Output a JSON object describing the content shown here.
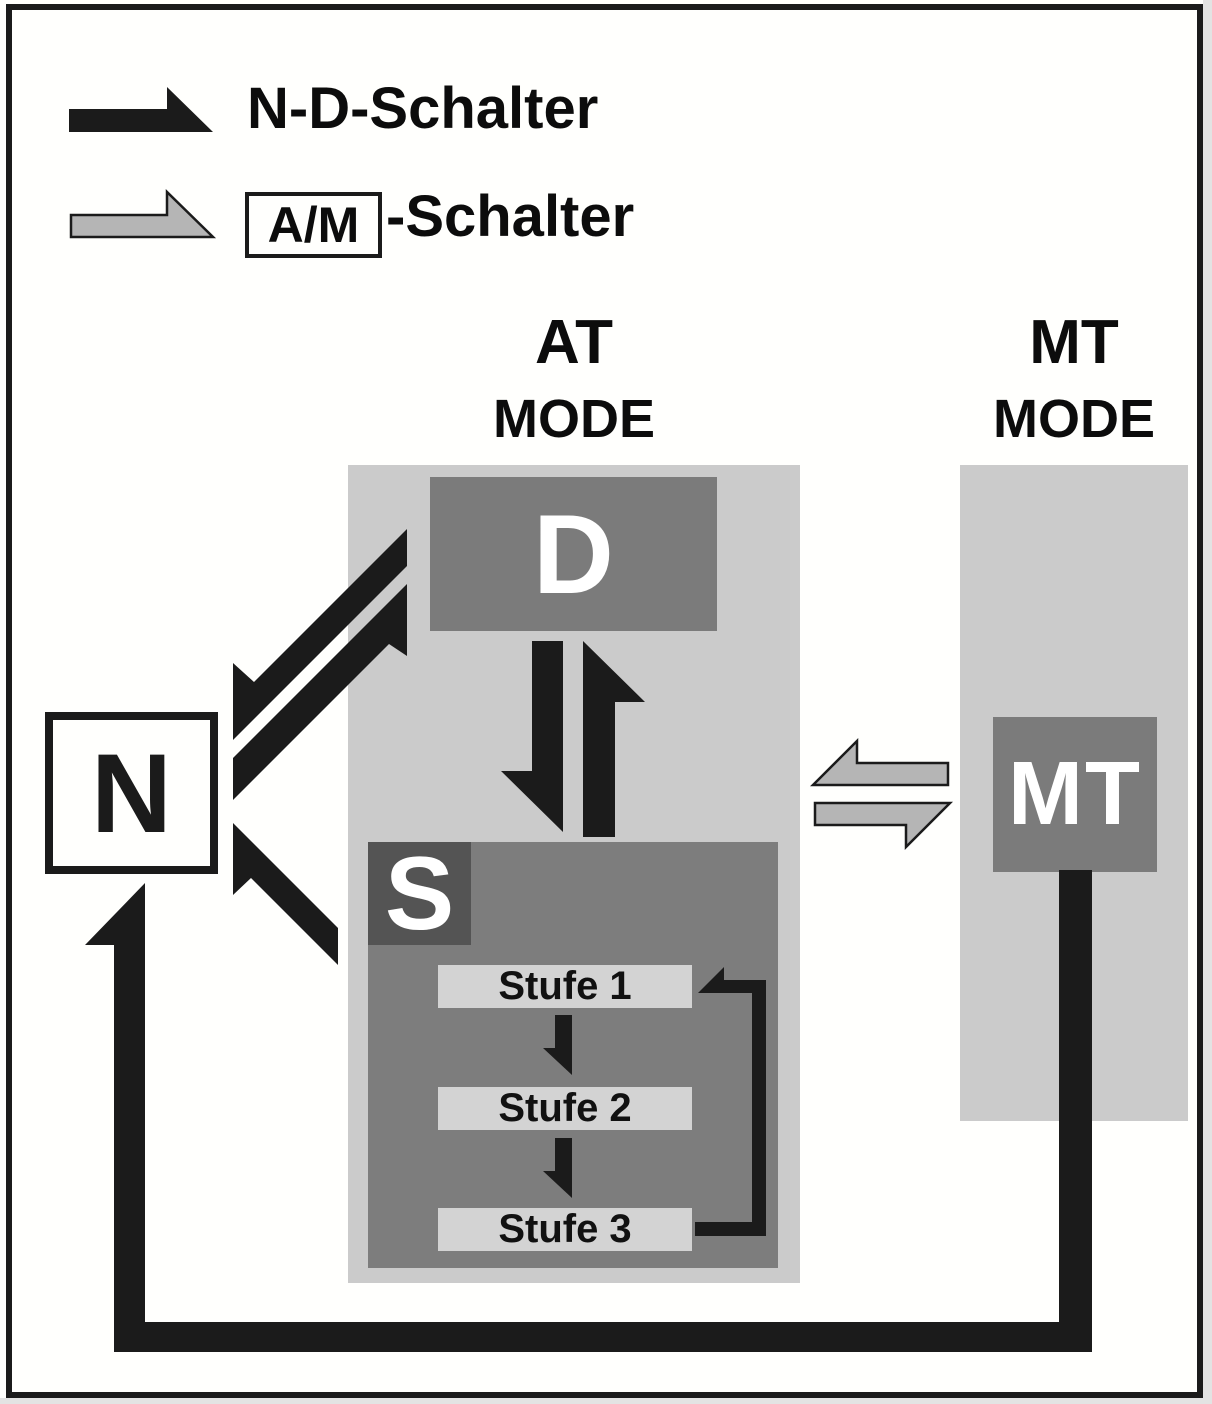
{
  "legend": {
    "nd_label": "N-D-Schalter",
    "am_box_label": "A/M",
    "am_suffix": "-Schalter"
  },
  "headers": {
    "at_title": "AT",
    "at_subtitle": "MODE",
    "mt_title": "MT",
    "mt_subtitle": "MODE"
  },
  "nodes": {
    "drive": "D",
    "neutral": "N",
    "stufen_mode": "S",
    "manual": "MT"
  },
  "stufen": [
    {
      "label": "Stufe 1"
    },
    {
      "label": "Stufe 2"
    },
    {
      "label": "Stufe 3"
    }
  ],
  "colors": {
    "outline_black": "#1b1b1b",
    "mode_area_gray": "#cbcbcb",
    "node_gray": "#7b7b7b",
    "s_badge_gray": "#545454",
    "stufe_bar_gray": "#d3d3d3",
    "am_arrow_gray": "#b5b5b5",
    "text_white": "#ffffff"
  }
}
